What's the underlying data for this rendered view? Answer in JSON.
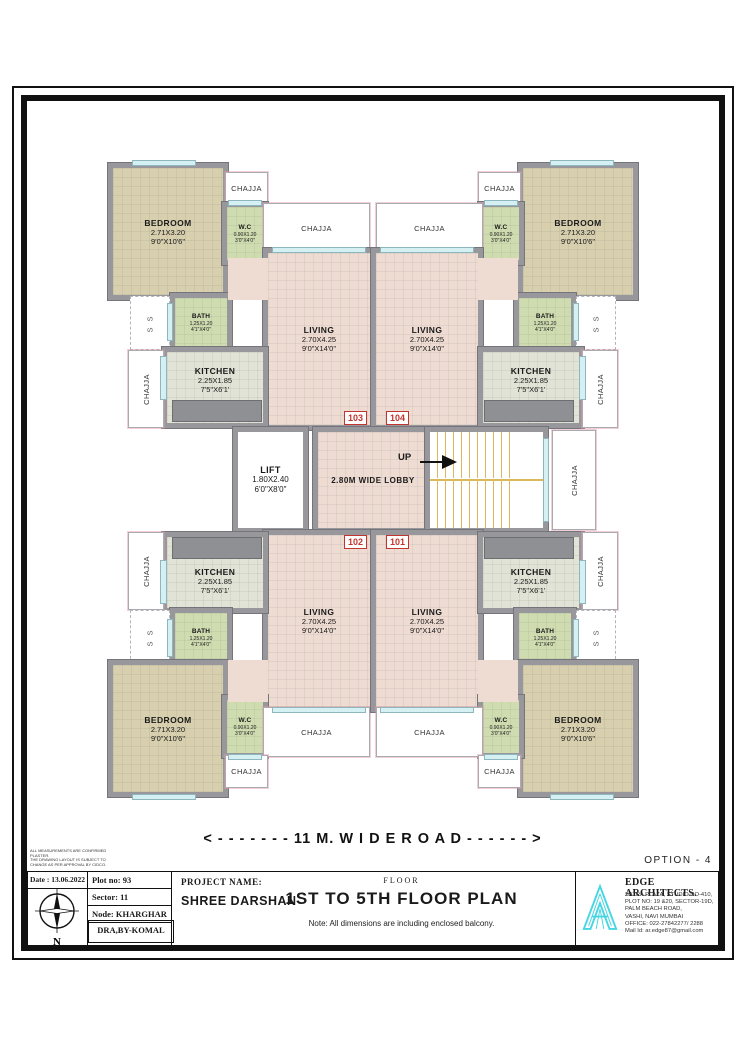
{
  "frame": {
    "option_label": "OPTION - 4",
    "road_label": "< - - - - - - -  11 M. W I D E  R O A D  - - - - - - >"
  },
  "rooms": {
    "bedroom": {
      "name": "BEDROOM",
      "metric": "2.71X3.20",
      "imperial": "9'0\"X10'6\""
    },
    "living": {
      "name": "LIVING",
      "metric": "2.70X4.25",
      "imperial": "9'0\"X14'0\""
    },
    "kitchen": {
      "name": "KITCHEN",
      "metric": "2.25X1.85",
      "imperial": "7'5\"X6'1'"
    },
    "bath": {
      "name": "BATH",
      "metric": "1.25X1.20",
      "imperial": "4'1\"X4'0\""
    },
    "wc": {
      "name": "W.C",
      "metric": "0.90X1.20",
      "imperial": "3'0\"X4'0\""
    },
    "lift": {
      "name": "LIFT",
      "metric": "1.80X2.40",
      "imperial": "6'0\"X8'0\""
    },
    "lobby_label": "2.80M WIDE LOBBY",
    "up_label": "UP",
    "chajja_label": "CHAJJA",
    "shaft_label": "S S"
  },
  "flats": {
    "tl": "103",
    "tr": "104",
    "bl": "102",
    "br": "101"
  },
  "titleblock": {
    "date": "Date : 13.06.2022",
    "compass_n": "N",
    "plot": "Plot no: 93",
    "sector": "Sector: 11",
    "node": "Node: KHARGHAR",
    "drawn": "DRA,BY-KOMAL",
    "project_label": "PROJECT NAME:",
    "project_name": "SHREE DARSHAN",
    "floor_label": "FLOOR",
    "title": "1ST TO 5TH FLOOR PLAN",
    "note": "Note: All dimensions are including enclosed balcony.",
    "architect": {
      "name": "EDGE ARCHITECTS.",
      "lines": [
        "SATRA PLAZA, STUDIO NO-410,",
        "PLOT NO: 19 &20, SECTOR-19D,",
        "PALM BEACH ROAD,",
        "VASHI, NAVI MUMBAI",
        "OFFICE: 022-27842277/ 2288",
        "Mail Id: ar.edge87@gmail.com"
      ]
    },
    "disclaimer": [
      "ALL MEASUREMENTS ARE CONFIRMED",
      "PLASTER.",
      "THE DRAWING LAYOUT IS SUBJECT TO",
      "CHANGE AS PER APPROVAL BY CIDCO."
    ]
  }
}
